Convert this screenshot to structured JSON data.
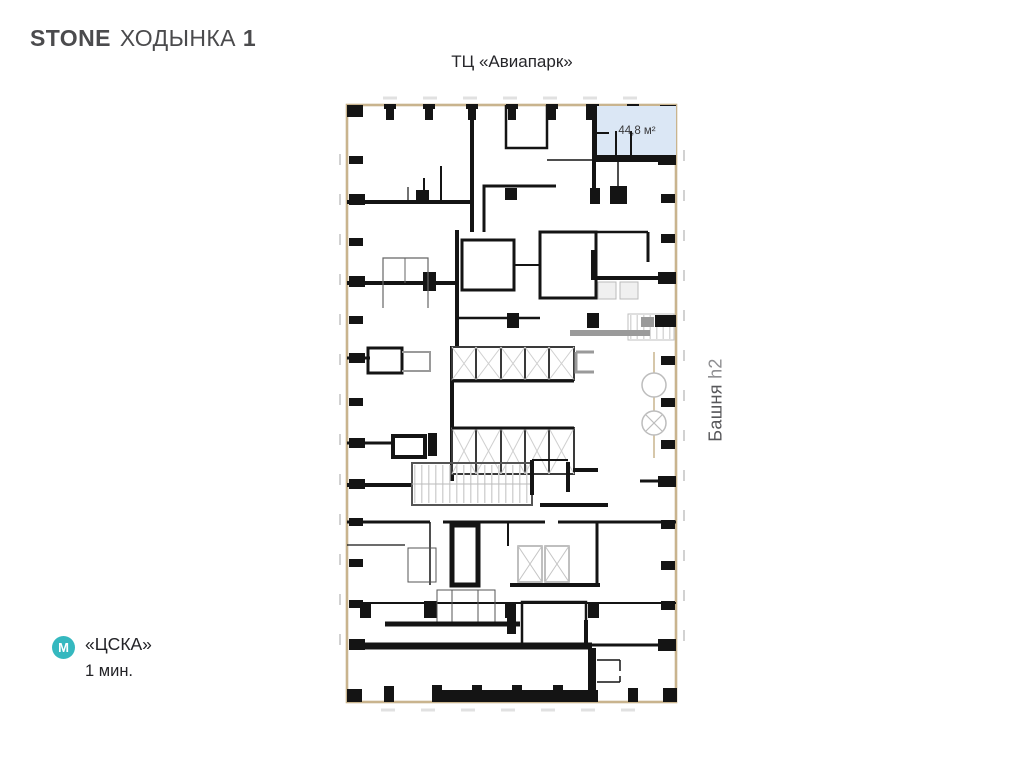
{
  "logo": {
    "brand": "STONE",
    "project": "ХОДЫНКА",
    "number": "1"
  },
  "labels": {
    "top": "ТЦ «Авиапарк»",
    "tower": "Башня",
    "tower_code": "h2"
  },
  "unit": {
    "area": "44,8 м²"
  },
  "metro": {
    "icon_letter": "М",
    "station": "«ЦСКА»",
    "time": "1 мин."
  },
  "colors": {
    "metro_accent": "#35b8bf",
    "unit_fill": "#dbe7f5",
    "facade_wall": "#c9b48e",
    "wall_black": "#141414",
    "logo_gray": "#4b4b4d"
  }
}
